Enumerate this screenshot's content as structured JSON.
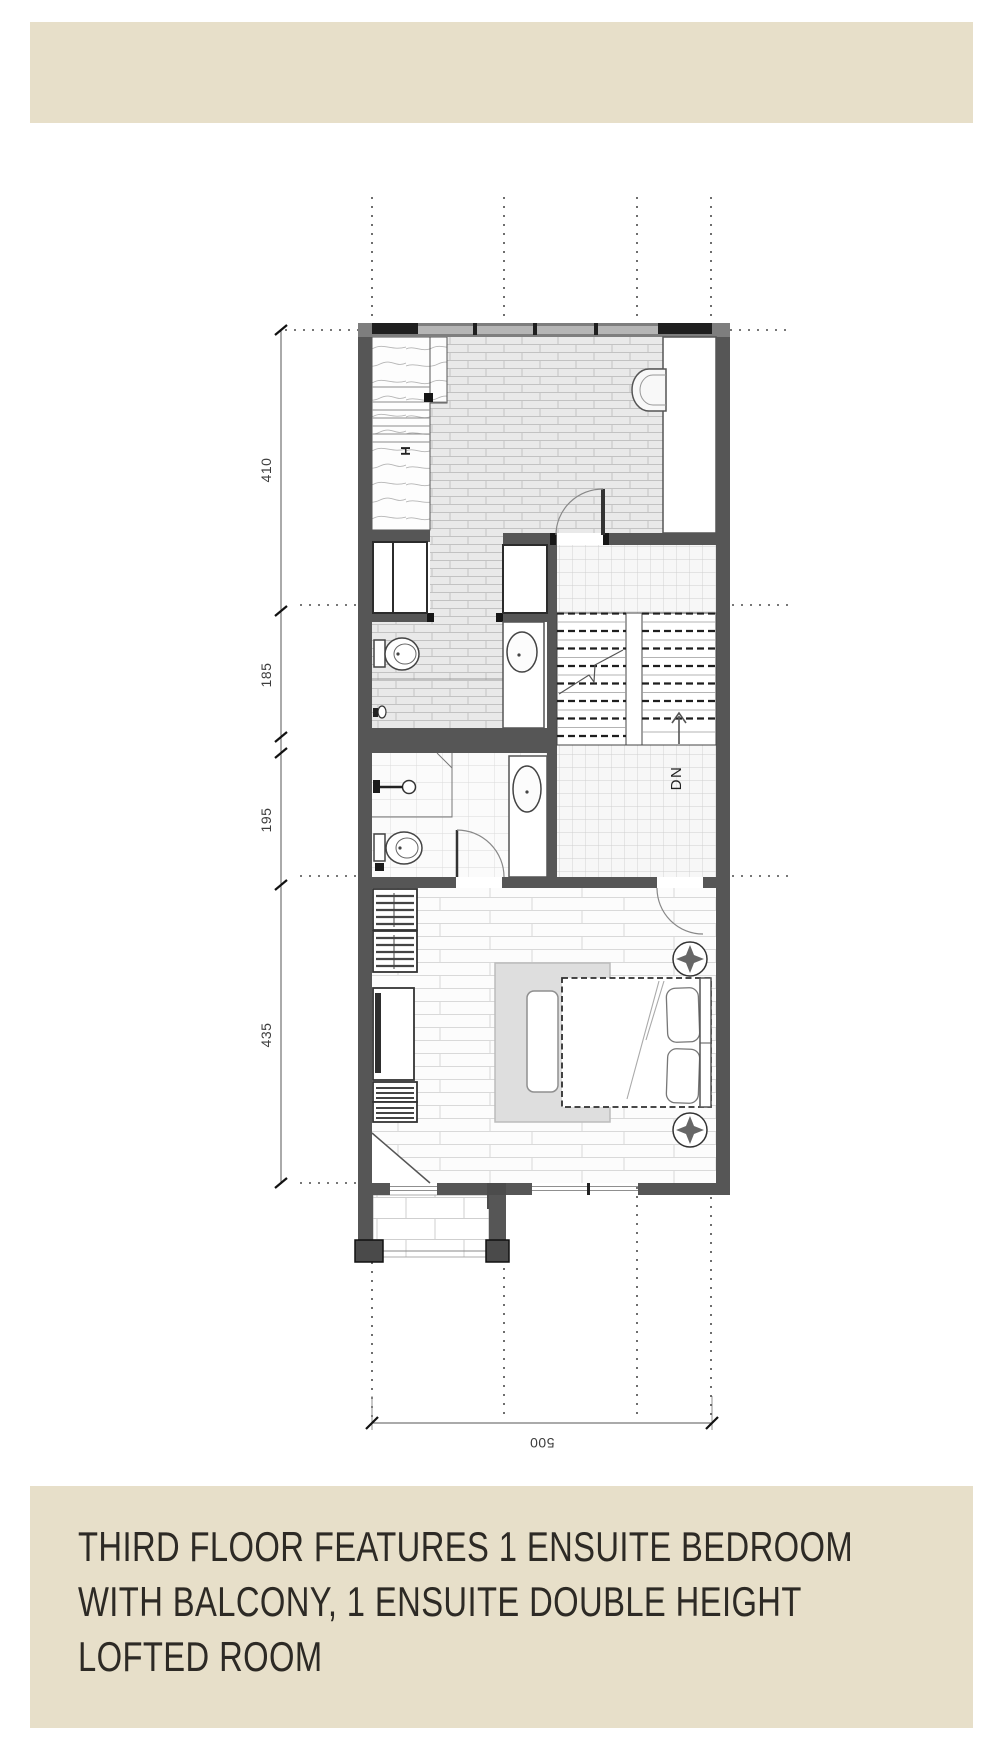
{
  "header": {
    "band_color": "#e7dfc9"
  },
  "footer": {
    "lines": [
      "THIRD FLOOR FEATURES 1 ENSUITE BEDROOM",
      "WITH BALCONY, 1 ENSUITE DOUBLE HEIGHT",
      "LOFTED ROOM"
    ],
    "text_color": "#2d2a25"
  },
  "plan": {
    "dim_left": [
      "410",
      "185",
      "195",
      "435"
    ],
    "dim_bottom": "500",
    "stair_label": "DN",
    "column_label": "H",
    "colors": {
      "wall": "#565656",
      "brick_floor": "#e9e9e9",
      "rug": "#dedede"
    }
  }
}
